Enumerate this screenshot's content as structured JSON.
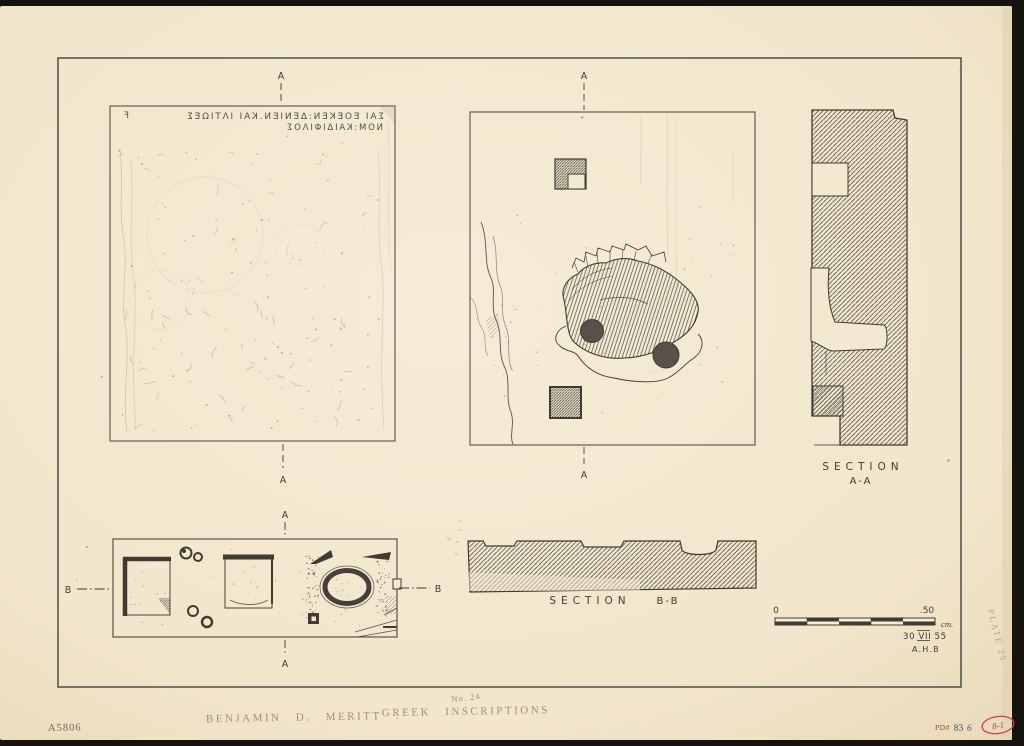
{
  "document": {
    "type": "archaeological plate drawing",
    "negative_number": "A5806",
    "plate_number": "PLATE 25",
    "pd_prefix": "PD#",
    "pd_digits": "83",
    "pd_suffix": "6",
    "red_code": "8-1",
    "caption": {
      "author": "BENJAMIN D. MERITT :",
      "title": "GREEK INSCRIPTIONS",
      "number": "No. 24"
    }
  },
  "inscription": {
    "writing_direction": "retrograde",
    "line1": "ΣΑΙ ΕΟΕΚΕΝ:ΔΕΝΙΕΝ.ΚΑΙ ΙΛΤΙΩΕΣ",
    "line2": "ΝΟΜ:ΚΑΙΔΙΦΙΛΟΣ",
    "edge_mark": "Ϝ"
  },
  "markers": {
    "a": "A",
    "b": "B"
  },
  "sections": {
    "aa": {
      "word": "SECTION",
      "name": "A-A"
    },
    "bb": {
      "word": "SECTION",
      "name": "B-B"
    }
  },
  "scale_bar": {
    "start": "0",
    "end": ".50",
    "unit": "cm.",
    "date": "30 VII 55",
    "initials": "A.H.B"
  },
  "colors": {
    "background": "#14130f",
    "paper": "#f3e8d0",
    "ink": "#3f3c35",
    "pencil": "#9a8c74",
    "red": "#c9404a",
    "blue": "#3a56b0"
  }
}
